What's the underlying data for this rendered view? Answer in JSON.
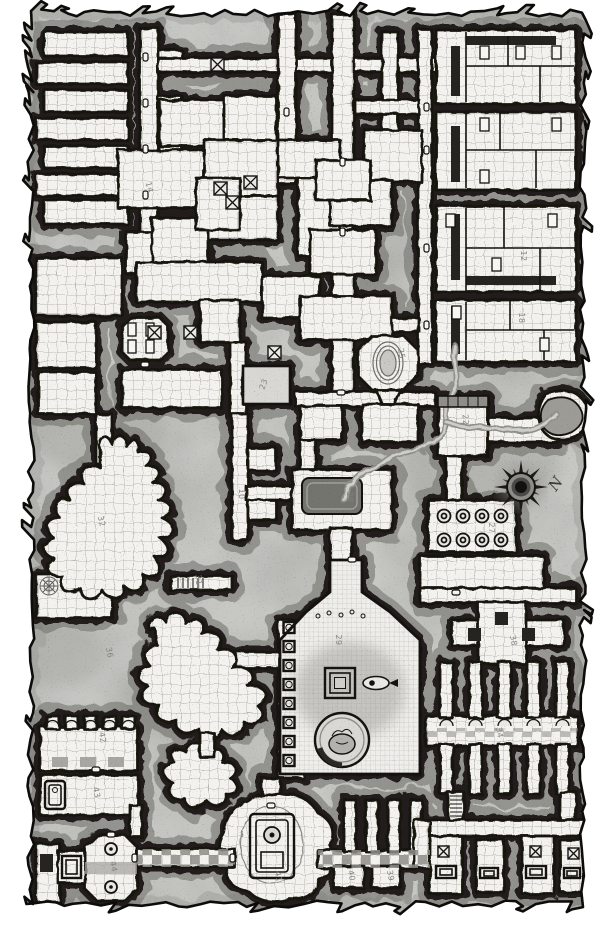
{
  "map": {
    "kind": "hand-drawn dungeon floorplan, black and white, square grid",
    "scale_note": "one square equals five feet",
    "compass": {
      "label": "N"
    },
    "palette": {
      "paper": "#ffffff",
      "parchment": "#c7c7c4",
      "room_floor": "#f3f2ef",
      "grid_line": "#b9b8b4",
      "wall_ink": "#15130f",
      "halo": "#201f1b",
      "shadow": "#6e6e68",
      "label": "#82817c",
      "water": "#90908b"
    },
    "room_labels": [
      {
        "text": "14",
        "x": 147,
        "y": 188,
        "rot": 75
      },
      {
        "text": "12",
        "x": 521,
        "y": 256,
        "rot": 90
      },
      {
        "text": "18",
        "x": 519,
        "y": 318,
        "rot": 90
      },
      {
        "text": "23",
        "x": 266,
        "y": 385,
        "rot": -70
      },
      {
        "text": "25",
        "x": 399,
        "y": 354,
        "rot": 80
      },
      {
        "text": "22",
        "x": 463,
        "y": 420,
        "rot": 85
      },
      {
        "text": "27",
        "x": 489,
        "y": 528,
        "rot": 90
      },
      {
        "text": "28",
        "x": 347,
        "y": 497,
        "rot": 90
      },
      {
        "text": "10",
        "x": 239,
        "y": 494,
        "rot": 90
      },
      {
        "text": "29",
        "x": 336,
        "y": 640,
        "rot": 90
      },
      {
        "text": "31",
        "x": 196,
        "y": 580,
        "rot": 85
      },
      {
        "text": "32",
        "x": 99,
        "y": 522,
        "rot": 75
      },
      {
        "text": "36",
        "x": 107,
        "y": 653,
        "rot": 80
      },
      {
        "text": "38",
        "x": 511,
        "y": 641,
        "rot": 80
      },
      {
        "text": "34",
        "x": 497,
        "y": 733,
        "rot": 80
      },
      {
        "text": "39",
        "x": 388,
        "y": 876,
        "rot": 80
      },
      {
        "text": "40",
        "x": 349,
        "y": 876,
        "rot": 80
      },
      {
        "text": "41",
        "x": 276,
        "y": 877,
        "rot": 80
      },
      {
        "text": "42",
        "x": 100,
        "y": 738,
        "rot": 80
      },
      {
        "text": "43",
        "x": 94,
        "y": 793,
        "rot": 80
      },
      {
        "text": "44",
        "x": 111,
        "y": 867,
        "rot": 80
      }
    ]
  }
}
